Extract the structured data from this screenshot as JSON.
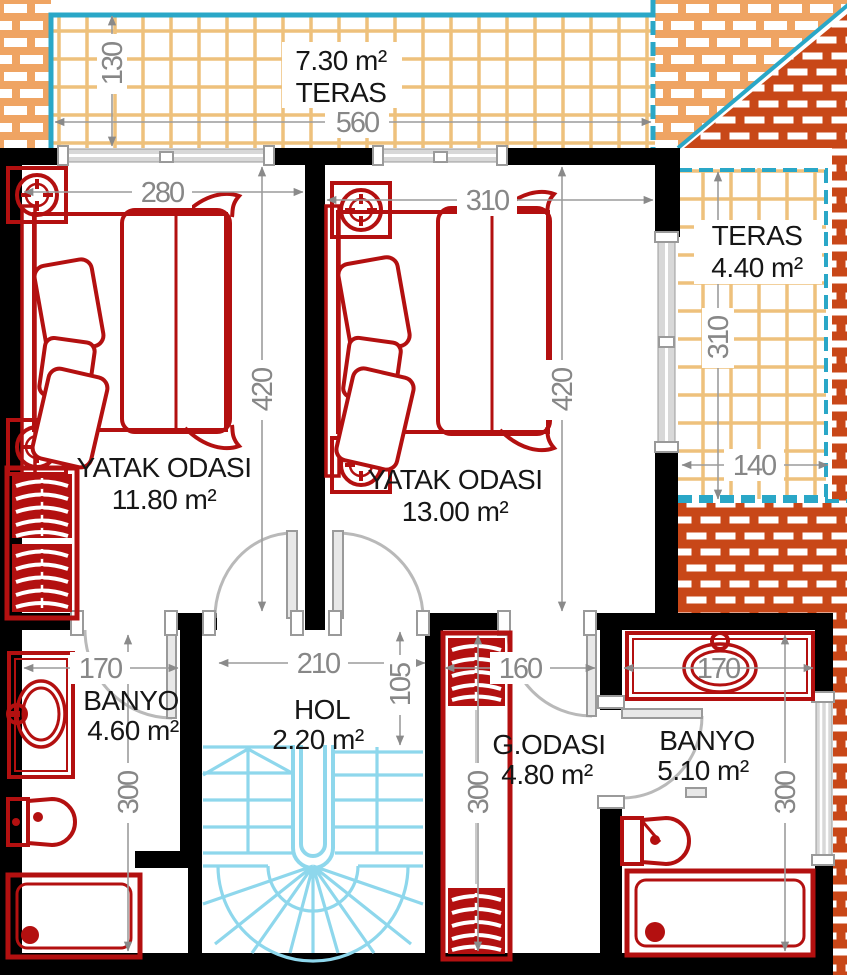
{
  "rooms": {
    "teras_top": {
      "name": "TERAS",
      "area": "7.30 m²",
      "dims": {
        "width": "560",
        "depth": "130"
      }
    },
    "yatak1": {
      "name": "YATAK ODASI",
      "area": "11.80 m²",
      "dims": {
        "width": "280",
        "depth": "420"
      }
    },
    "yatak2": {
      "name": "YATAK ODASI",
      "area": "13.00 m²",
      "dims": {
        "width": "310",
        "depth": "420"
      }
    },
    "teras_right": {
      "name": "TERAS",
      "area": "4.40 m²",
      "dims": {
        "width": "140",
        "depth": "310"
      }
    },
    "banyo1": {
      "name": "BANYO",
      "area": "4.60 m²",
      "dims": {
        "width": "170",
        "depth": "300"
      }
    },
    "hol": {
      "name": "HOL",
      "area": "2.20 m²",
      "dims": {
        "width": "210",
        "depth": "105"
      }
    },
    "godasi": {
      "name": "G.ODASI",
      "area": "4.80 m²",
      "dims": {
        "width": "160",
        "depth": "300"
      }
    },
    "banyo2": {
      "name": "BANYO",
      "area": "5.10 m²",
      "dims": {
        "width": "170",
        "depth": "300"
      }
    }
  },
  "colors": {
    "walls": "#000000",
    "furniture_red": "#b31010",
    "stairs_blue": "#8ed7ec",
    "terrace_border_teal": "#2aa7c7",
    "tile_grid": "#eec17c",
    "brick_light": "#efa463",
    "brick_dark": "#c84718",
    "dimension_gray": "#878787",
    "door_gray": "#b9b9b9"
  }
}
